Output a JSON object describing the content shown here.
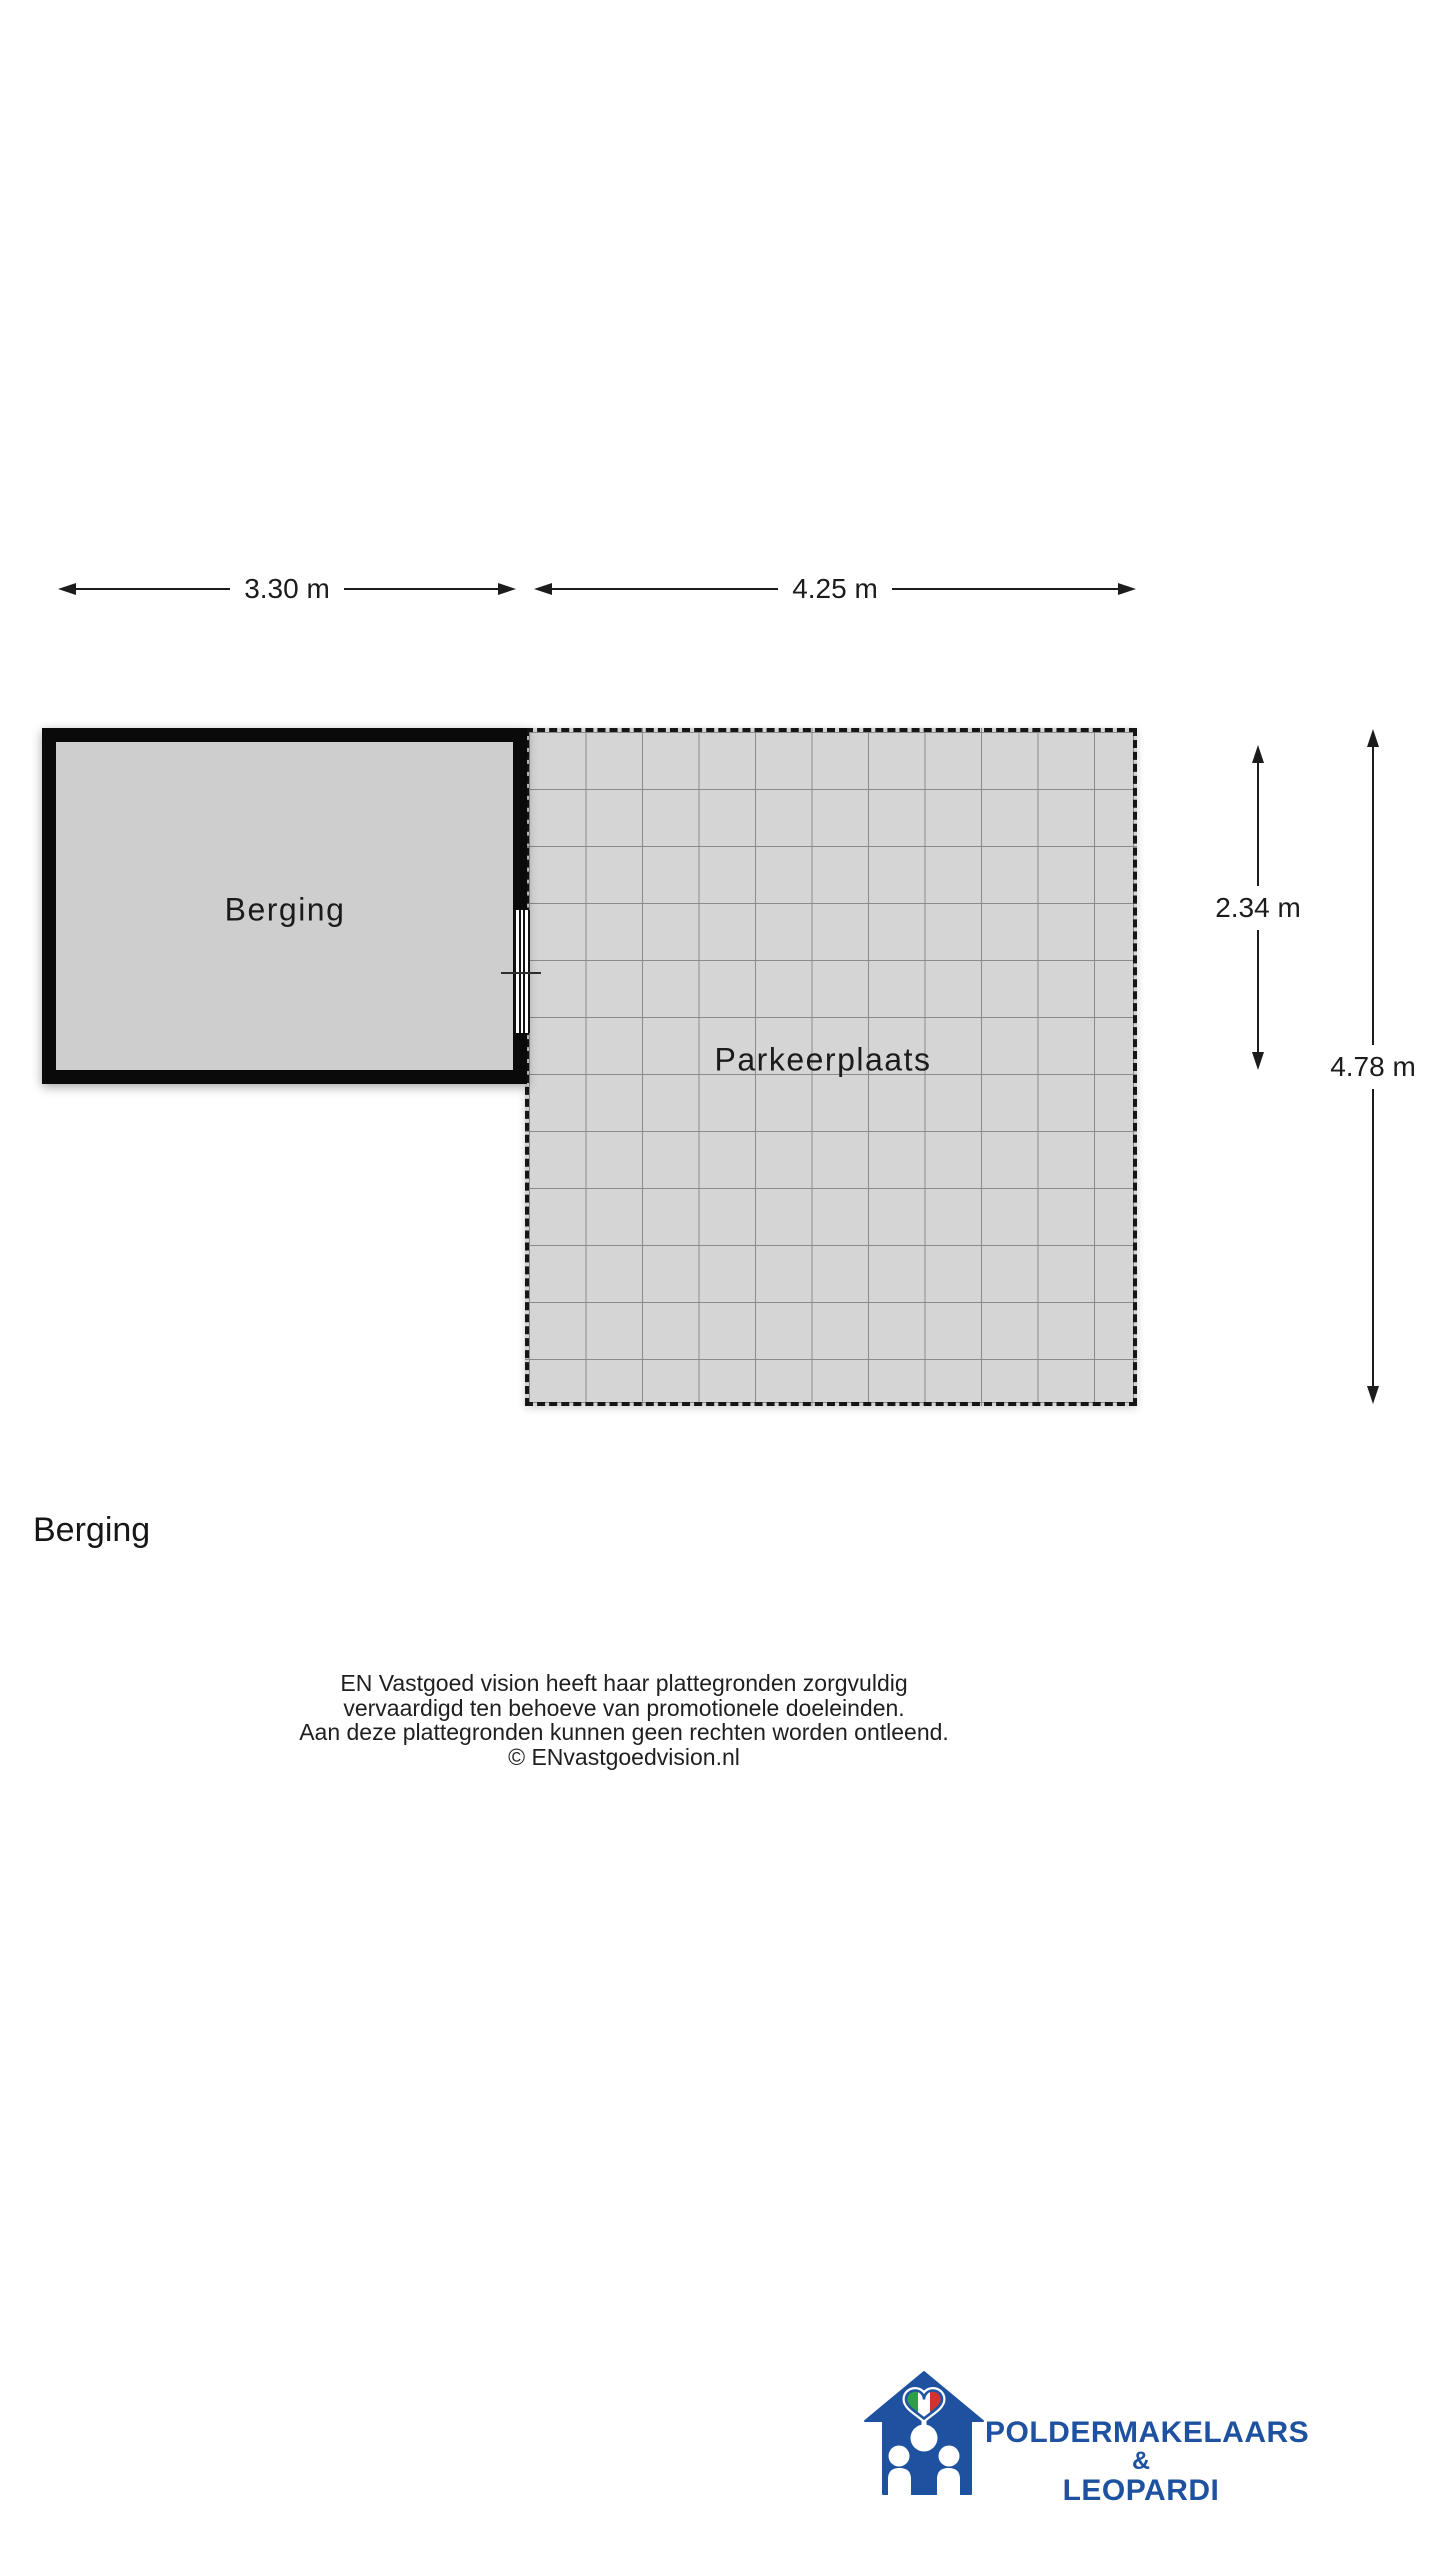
{
  "floorplan": {
    "rooms": [
      {
        "label": "Berging"
      },
      {
        "label": "Parkeerplaats"
      }
    ],
    "dimensions": {
      "berging_width": "3.30 m",
      "parkeerplaats_width": "4.25 m",
      "berging_height": "2.34 m",
      "parkeerplaats_height": "4.78 m"
    }
  },
  "heading": {
    "title": "Berging"
  },
  "disclaimer": {
    "lines": [
      "EN Vastgoed vision heeft haar plattegronden zorgvuldig",
      "vervaardigd ten behoeve van promotionele doeleinden.",
      "Aan deze plattegronden kunnen geen rechten worden ontleend.",
      "© ENvastgoedvision.nl"
    ]
  },
  "logo": {
    "name_top": "POLDERMAKELAARS",
    "ampersand": "&",
    "name_bottom": "LEOPARDI"
  },
  "colors": {
    "wall": "#0a0a0a",
    "berging_fill": "#cecece",
    "parking_fill": "#d5d5d5",
    "grid_line": "#8a8a8a",
    "dim_line": "#1c1c1c",
    "text": "#1c1c1c",
    "logo_blue": "#1e52a0",
    "heart_green": "#2f9e49",
    "heart_red": "#d1342f",
    "heart_outline": "#1f55a2"
  }
}
